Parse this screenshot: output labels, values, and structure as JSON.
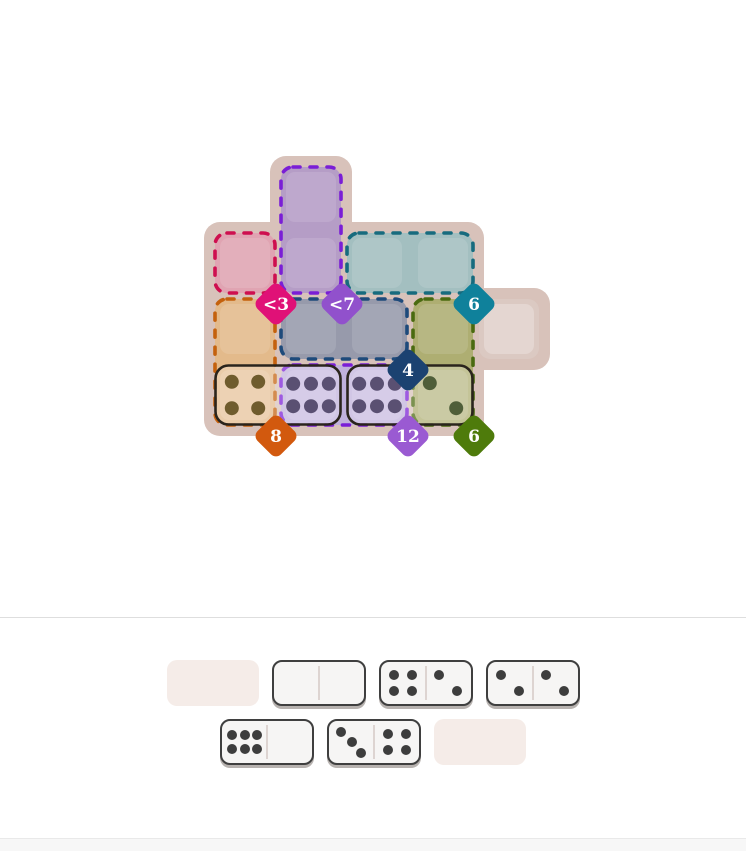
{
  "page": {
    "background": "#ffffff",
    "divider_color": "#dedede",
    "footer_bg": "#f7f7f7",
    "footer_border": "#e9e9e9"
  },
  "board": {
    "bg_color": "#d8c2ba",
    "grid": {
      "cols": 5,
      "rows": 4
    },
    "background_blocks": [
      {
        "from_col": 0,
        "from_row": 1,
        "to_col": 3,
        "to_row": 3
      },
      {
        "from_col": 1,
        "from_row": 0,
        "to_col": 1,
        "to_row": 1
      },
      {
        "from_col": 4,
        "from_row": 2,
        "to_col": 4,
        "to_row": 2
      }
    ],
    "plain_cells": [
      {
        "col": 4,
        "row": 2,
        "fill": "#dbc9c2"
      }
    ],
    "regions": [
      {
        "id": "pink",
        "constraint": "<3",
        "fill": "#e0a4b2",
        "border": "#ce0f4f",
        "badge_color": "#e01177",
        "cells": [
          {
            "col": 0,
            "row": 1
          }
        ],
        "badge_corner": {
          "col": 1,
          "row": 2
        }
      },
      {
        "id": "violet",
        "constraint": "<7",
        "fill": "#b59dc6",
        "border": "#7a1ed6",
        "badge_color": "#9151cc",
        "cells": [
          {
            "col": 1,
            "row": 0
          },
          {
            "col": 1,
            "row": 1
          }
        ],
        "badge_corner": {
          "col": 2,
          "row": 2
        }
      },
      {
        "id": "teal",
        "constraint": "6",
        "fill": "#a3bfc0",
        "border": "#176b7e",
        "badge_color": "#0f819b",
        "cells": [
          {
            "col": 2,
            "row": 1
          },
          {
            "col": 3,
            "row": 1
          }
        ],
        "badge_corner": {
          "col": 4,
          "row": 2
        }
      },
      {
        "id": "orange",
        "constraint": "8",
        "fill": "#e3ba8b",
        "border": "#c4610d",
        "badge_color": "#d2590e",
        "cells": [
          {
            "col": 0,
            "row": 2
          },
          {
            "col": 0,
            "row": 3
          }
        ],
        "badge_corner": {
          "col": 1,
          "row": 4
        }
      },
      {
        "id": "navy",
        "constraint": "4",
        "fill": "#979aab",
        "border": "#1e4a7b",
        "badge_color": "#1b4271",
        "cells": [
          {
            "col": 1,
            "row": 2
          },
          {
            "col": 2,
            "row": 2
          }
        ],
        "badge_corner": {
          "col": 3,
          "row": 3
        }
      },
      {
        "id": "olive",
        "constraint": "6",
        "fill": "#aeae72",
        "border": "#4a6a10",
        "badge_color": "#4e7b0b",
        "cells": [
          {
            "col": 3,
            "row": 2
          },
          {
            "col": 3,
            "row": 3
          }
        ],
        "badge_corner": {
          "col": 4,
          "row": 4
        }
      },
      {
        "id": "lilac",
        "constraint": "12",
        "fill": "#c0b1dc",
        "border": "#7a1ed6",
        "badge_color": "#9a5ad2",
        "cells": [
          {
            "col": 1,
            "row": 3
          },
          {
            "col": 2,
            "row": 3
          }
        ],
        "badge_corner": {
          "col": 3,
          "row": 4
        }
      }
    ],
    "placed_dominoes": [
      {
        "halves": [
          {
            "col": 0,
            "row": 3,
            "pips": 4,
            "pip_color": "#6f5c2e"
          },
          {
            "col": 1,
            "row": 3,
            "pips": 6,
            "pip_color": "#5a5072"
          }
        ]
      },
      {
        "halves": [
          {
            "col": 2,
            "row": 3,
            "pips": 6,
            "pip_color": "#5a5072"
          },
          {
            "col": 3,
            "row": 3,
            "pips": 2,
            "pip_color": "#4f5e39"
          }
        ]
      }
    ],
    "placed_border_color": "#2a241c"
  },
  "tray": {
    "slot_color": "#f5ece8",
    "domino_colors": {
      "fill": "#f6f5f4",
      "border": "#3f3f3f",
      "pip": "#3d3d3d",
      "divider": "#ddd4d1",
      "shadow": "#b7b2af"
    },
    "rows": [
      [
        {
          "type": "slot"
        },
        {
          "type": "domino",
          "pips": [
            0,
            0
          ]
        },
        {
          "type": "domino",
          "pips": [
            4,
            2
          ]
        },
        {
          "type": "domino",
          "pips": [
            2,
            2
          ]
        }
      ],
      [
        {
          "type": "domino",
          "pips": [
            6,
            0
          ]
        },
        {
          "type": "domino",
          "pips": [
            3,
            4
          ]
        },
        {
          "type": "slot"
        }
      ]
    ]
  }
}
